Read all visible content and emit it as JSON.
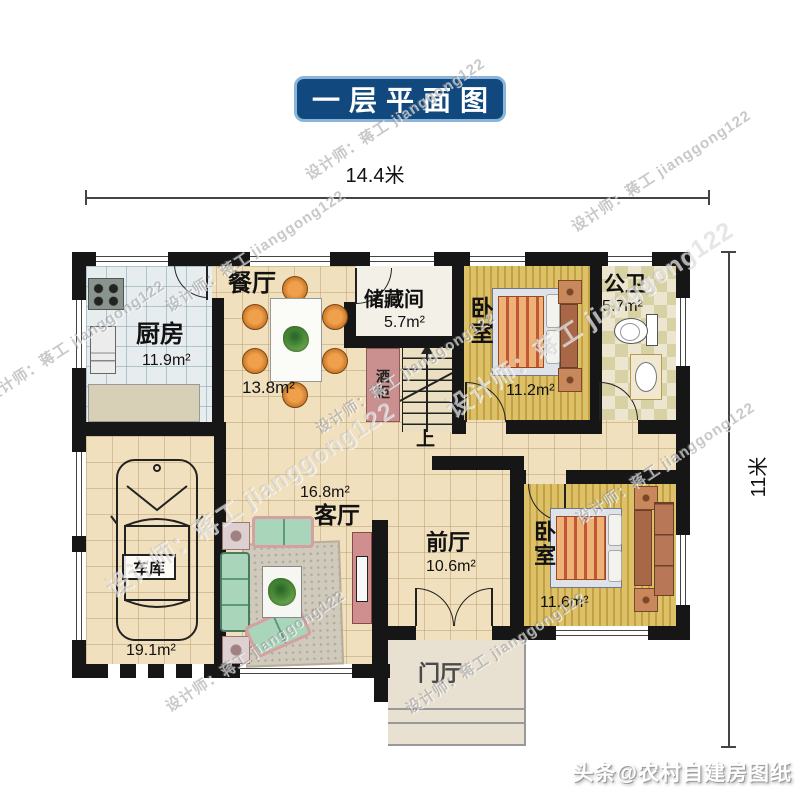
{
  "title": "一层平面图",
  "dimensions": {
    "width": "14.4米",
    "height": "11米"
  },
  "rooms": {
    "kitchen": {
      "name": "厨房",
      "area": "11.9m²"
    },
    "dining": {
      "name": "餐厅",
      "area": "13.8m²"
    },
    "storage": {
      "name": "储藏间",
      "area": "5.7m²"
    },
    "bedroom1": {
      "name": "卧室",
      "area": "11.2m²"
    },
    "bathroom": {
      "name": "公卫",
      "area": "5.7m²"
    },
    "living": {
      "name": "客厅",
      "area": "16.8m²"
    },
    "front_hall": {
      "name": "前厅",
      "area": "10.6m²"
    },
    "bedroom2": {
      "name": "卧室",
      "area": "11.6m²"
    },
    "garage": {
      "name": "车库",
      "area": "19.1m²"
    },
    "porch": {
      "name": "门厅"
    },
    "wine_cabinet": {
      "name": "酒柜"
    },
    "stairs": {
      "label": "上"
    }
  },
  "watermarks": {
    "designer": "设计师：蒋工 jianggong122",
    "brand": "头条@农村自建房图纸"
  },
  "colors": {
    "banner_bg": "#11497e",
    "banner_border": "#8ab4da",
    "banner_text": "#ffffff",
    "wall": "#161616",
    "floor_cream": "#f1e0bd",
    "floor_wood": "#dcc168",
    "floor_kitchen": "#e7edef",
    "floor_bath_a": "#d8d1a4",
    "floor_bath_b": "#ece5cf",
    "wine_cabinet": "#c9908f",
    "porch": "#e8e0d0"
  }
}
